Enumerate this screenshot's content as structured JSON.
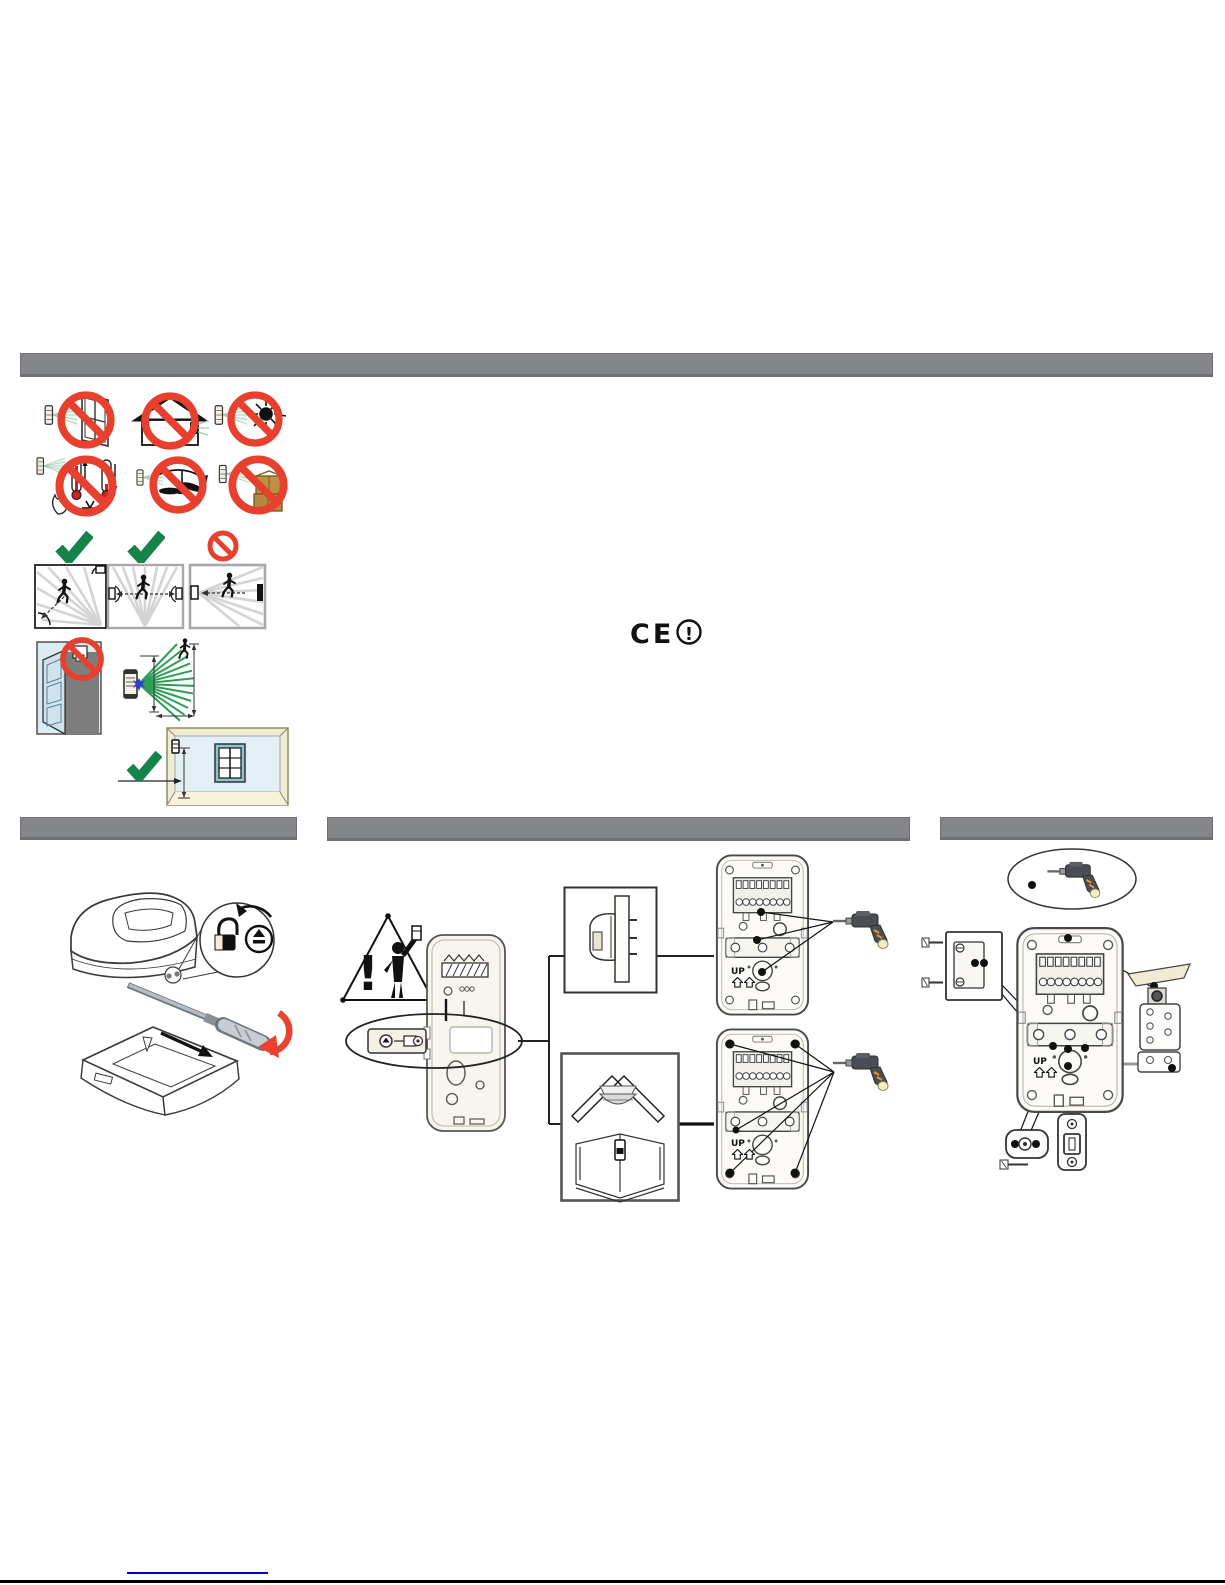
{
  "labels": {
    "up": "UP",
    "ce_mark": "CE",
    "ce_alert_exclamation": "!",
    "warning_exclamation": "!"
  },
  "colors": {
    "section_bar_gray": "#84868a",
    "prohibition_red": "#e8402f",
    "check_green": "#16834a",
    "beam_green": "#2f9e57",
    "beam_pale_green": "#9fc8ab",
    "link_blue": "#0000cc",
    "wall_light_blue": "#dcebf2",
    "room_trim_beige": "#efecd4",
    "carton_brown": "#b5883f",
    "drill_body_gray": "#4a4e54",
    "drill_butt_cream": "#f4eec2",
    "screwdriver_red_arrow": "#e8432f",
    "star_blue": "#2b3fd4"
  },
  "icons": {
    "placement_prohibitions": [
      "no-aiming-at-window",
      "no-outdoor-installation",
      "no-direct-sunlight",
      "no-heat-or-cold-sources",
      "no-fans-moving-objects",
      "no-obstructions-in-front"
    ],
    "detection_guidance": [
      "crosswise-movement-detected-ok",
      "crosswise-two-detectors-ok",
      "head-on-movement-not-recommended",
      "do-not-mount-above-door",
      "detection-fan-pattern-with-person",
      "room-mounting-height-ok"
    ],
    "compliance": [
      "ce-mark-with-alert"
    ],
    "open_housing": [
      "unlock-rotate-screw-magnifier",
      "screwdriver",
      "slide-cover-arrow",
      "rotate-screwdriver-red-arrow"
    ],
    "mounting": [
      "installer-warning-triangle",
      "open-detector-back",
      "knockout-detail-oval",
      "flat-wall-mount-option",
      "corner-mount-option",
      "mounting-base-flat-holes",
      "mounting-base-corner-holes",
      "drill"
    ],
    "bracket_mounting": [
      "drill-oval",
      "wall-plate-with-screws",
      "mounting-base",
      "swivel-bracket",
      "ball-joint-pieces",
      "fixing-screw"
    ]
  },
  "footer": {
    "has_link_underline": true
  }
}
